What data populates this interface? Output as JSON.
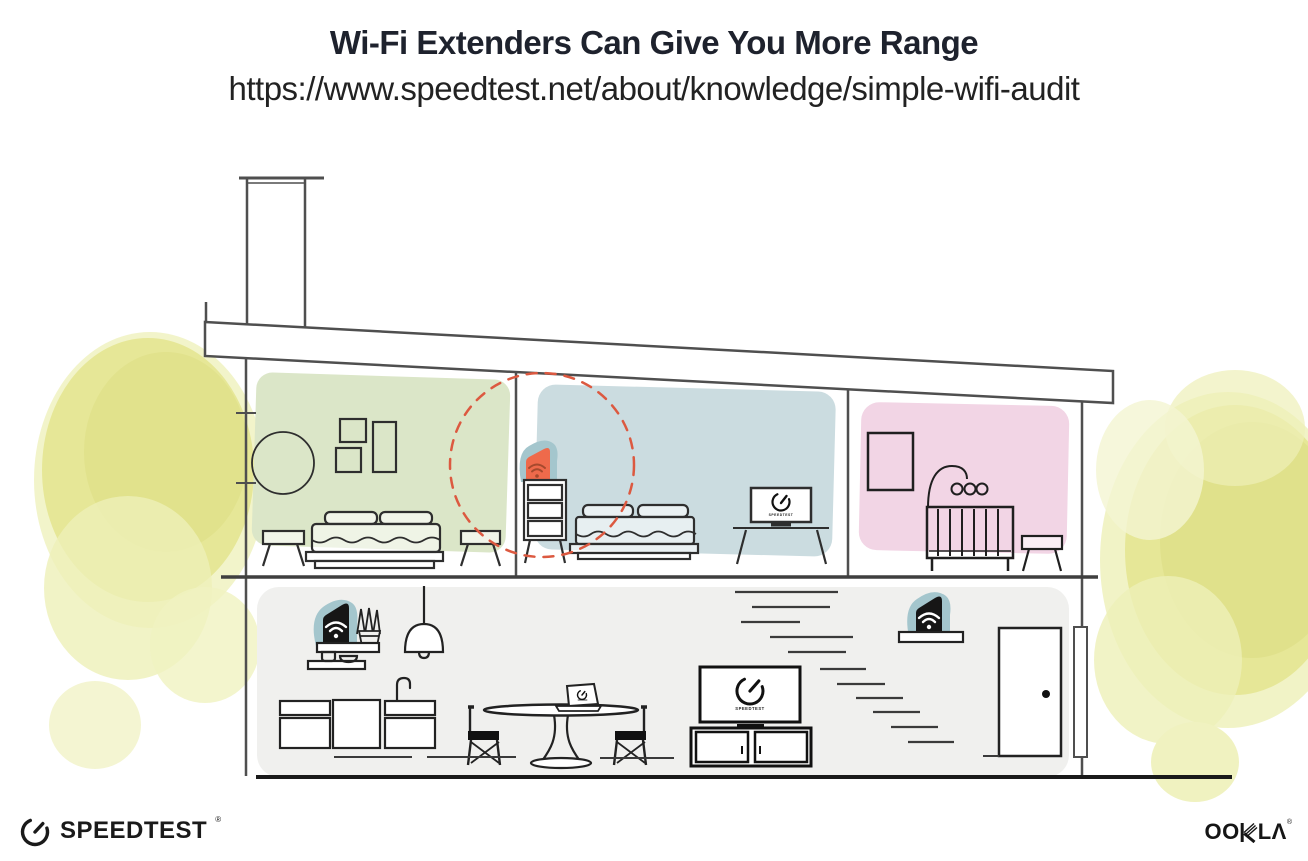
{
  "header": {
    "title": "Wi-Fi Extenders Can Give You More Range",
    "url": "https://www.speedtest.net/about/knowledge/simple-wifi-audit"
  },
  "illustration": {
    "tv_screen_label": "SPEEDTEST",
    "icons": {
      "router": "wifi-router",
      "extender": "wifi-extender",
      "wifi": "wifi-signal",
      "gauge": "speedometer-gauge",
      "range": "extender-range-dashed-circle"
    },
    "colors": {
      "room_green": "#dbe6c8",
      "room_blue": "#cbdce0",
      "room_pink": "#f2d5e5",
      "lower_floor_gray": "#f0f0ee",
      "device_teal": "#a4c6cd",
      "extender_orange": "#ee6a4b",
      "wifi_on_orange": "#a6492d",
      "range_circle_red": "#dc5940",
      "foliage_yellow": "#e5e697",
      "structure_line": "#4f4f4f",
      "ink": "#1d1d1d"
    }
  },
  "footer": {
    "speedtest_wordmark": "SPEEDTEST",
    "speedtest_trademark": "®",
    "ookla_oo": "OO",
    "ookla_la": "LΛ",
    "ookla_trademark": "®"
  }
}
